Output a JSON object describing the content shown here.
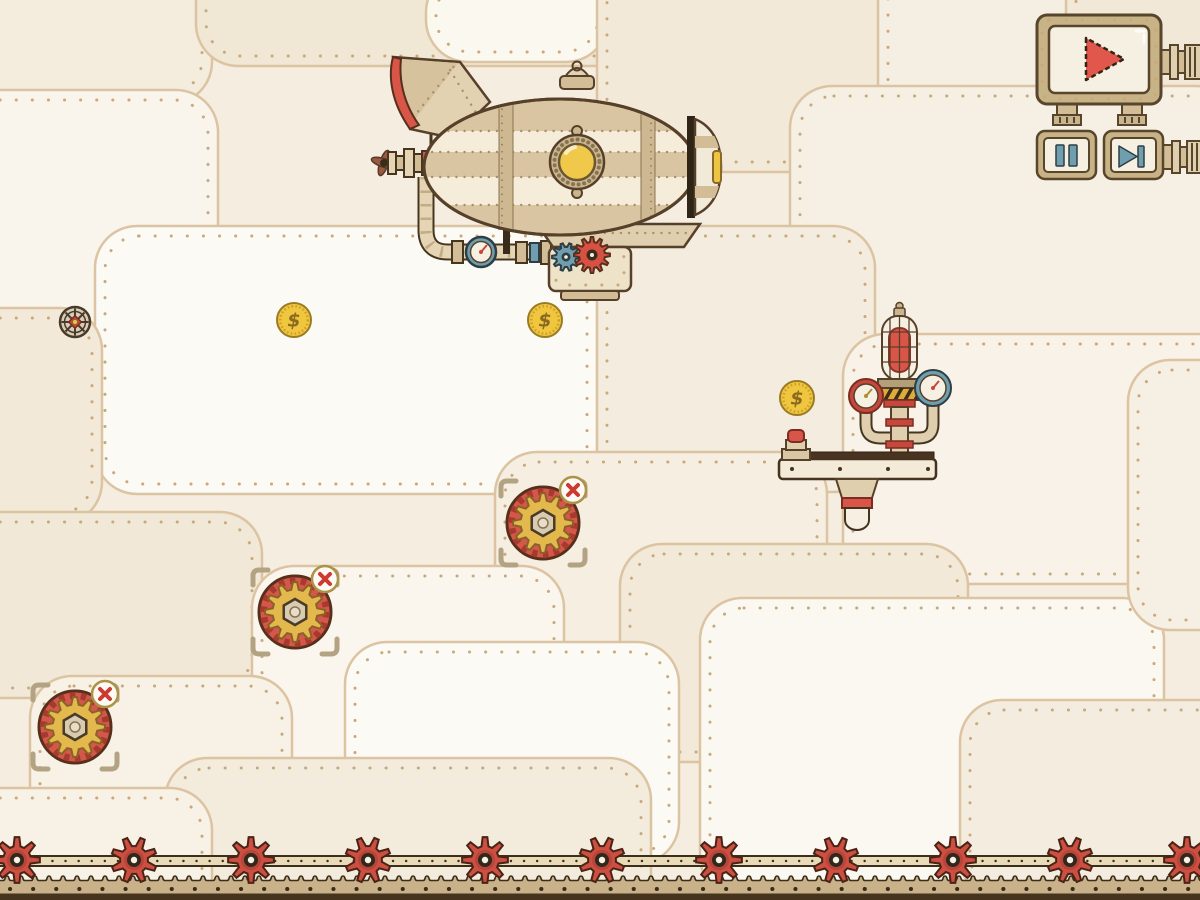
{
  "meta": {
    "app": "steampunk-machine-puzzle-level",
    "canvas": {
      "width": 1200,
      "height": 900
    }
  },
  "colors": {
    "red": "#d95548",
    "deep_red": "#c6483c",
    "teal": "#6f9fae",
    "gold": "#eec445",
    "brass": "#c8b387",
    "pipe": "#e0cfae",
    "cream": "#f6f0e2",
    "coin": "#f0c63f",
    "outline": "#47361f",
    "panel_line": "#dcc4a2",
    "rivet": "#c9a97c",
    "ground": "#c9b28a",
    "ground_dark": "#3a2c1a",
    "bg": "#f4ede0"
  },
  "hud": {
    "play_button": {
      "icon": "play-icon",
      "color": "#e2574c"
    },
    "pause_button": {
      "icon": "pause-icon",
      "color": "#6f9fae"
    },
    "skip_button": {
      "icon": "skip-icon",
      "color": "#6f9fae"
    }
  },
  "entities": {
    "coin_symbol": "$",
    "coins": [
      {
        "x": 294,
        "y": 320
      },
      {
        "x": 545,
        "y": 320
      },
      {
        "x": 797,
        "y": 398
      }
    ],
    "collectible_gears": [
      {
        "x": 543,
        "y": 523
      },
      {
        "x": 295,
        "y": 612
      },
      {
        "x": 75,
        "y": 727
      }
    ],
    "valve_wheel": {
      "x": 75,
      "y": 322
    },
    "conveyor_gear_xs": [
      17,
      134,
      251,
      368,
      485,
      602,
      719,
      836,
      953,
      1070,
      1187
    ],
    "conveyor_y": 860
  },
  "structures": {
    "airship": {
      "x": 560,
      "y": 167,
      "parts": [
        "balloon",
        "porthole",
        "tail-fin",
        "propeller",
        "gondola",
        "pipes",
        "pressure-gauge",
        "drive-gears"
      ]
    },
    "signal_machine": {
      "x": 898,
      "y": 430,
      "parts": [
        "caged-siren-lamp",
        "red-gauge",
        "teal-gauge",
        "red-button",
        "platform",
        "piston-bell"
      ]
    }
  }
}
